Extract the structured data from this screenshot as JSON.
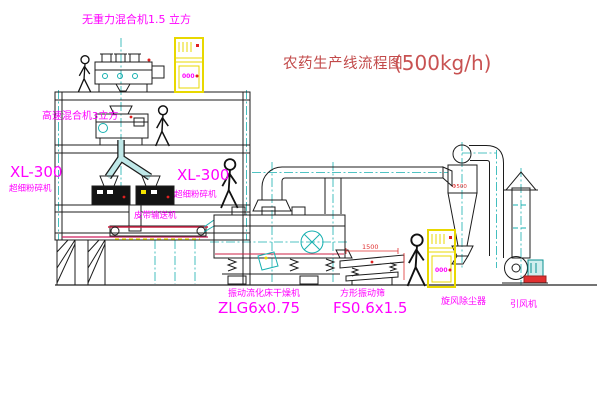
{
  "title": {
    "main": "农药生产线流程图",
    "capacity": "(500kg/h)"
  },
  "labels": {
    "gravity_mixer": "无重力混合机1.5 立方",
    "high_speed_mixer": "高速混合机3立方",
    "mill_left_model": "XL-300",
    "mill_left_name": "超细粉碎机",
    "mill_center_model": "XL-300",
    "mill_center_name": "超细粉碎机",
    "belt_conveyor": "皮带输送机",
    "dryer_name": "振动流化床干燥机",
    "dryer_model": "ZLG6x0.75",
    "sieve_name": "方形振动筛",
    "sieve_model": "FS0.6x1.5",
    "cyclone_name": "旋风除尘器",
    "fan_name": "引风机"
  },
  "annotations": {
    "sieve_width_dim": "1500",
    "cyclone_dia_dim": "Φ500",
    "cabinet1_display": "000",
    "cabinet2_display": "000"
  },
  "colors": {
    "background": "#ffffff",
    "line_black": "#1c1c1c",
    "line_teal": "#17b0b0",
    "label_magenta": "#ff00ff",
    "title_red": "#c24a4a",
    "cabinet_yellow": "#e8d800",
    "alert_red": "#e02020"
  }
}
